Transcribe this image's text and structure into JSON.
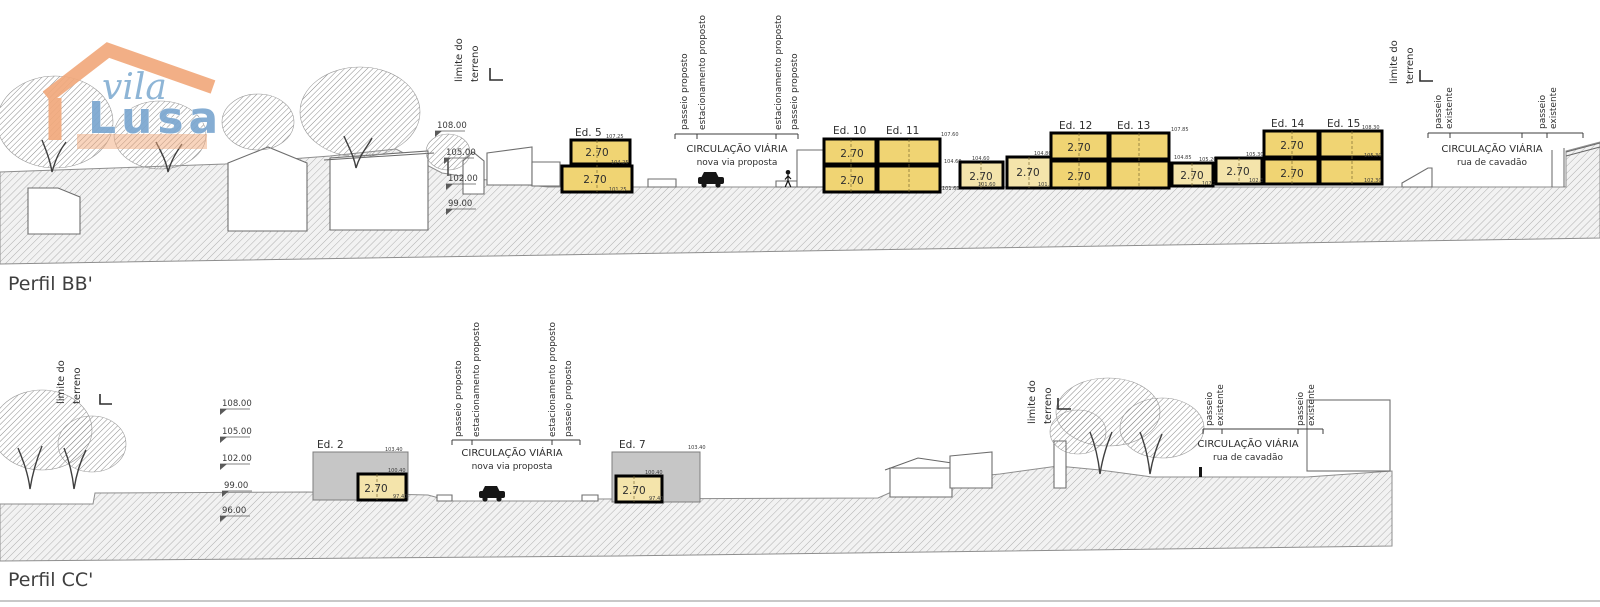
{
  "colors": {
    "proposed_building_fill": "#f0d473",
    "infill_building_fill": "#f4e4ab",
    "existing_building_fill": "#c6c6c6",
    "ground_hatch_line": "#a8a8a8",
    "logo_orange": "#f1a97c",
    "logo_blue": "#7ba7d0"
  },
  "logo": {
    "word1": "vila",
    "word2": "Lusa"
  },
  "labels": {
    "limite_line1": "limite do",
    "limite_line2": "terreno",
    "passeio_proposto": "passeio proposto",
    "estacionamento_proposto": "estacionamento proposto",
    "passeio_line1": "passeio",
    "existente_line2": "existente",
    "circulacao_viaria": "CIRCULAÇÃO VIÁRIA",
    "nova_via_proposta": "nova via proposta",
    "rua_de_cavadao": "rua de cavadão"
  },
  "profile_bb": {
    "title": "Perfil BB'",
    "elevations": [
      "108.00",
      "105.00",
      "102.00",
      "99.00"
    ],
    "buildings": [
      {
        "label": "Ed. 5",
        "floor_height": "2.70",
        "marks": [
          "107.25",
          "104.25",
          "101.25"
        ]
      },
      {
        "label": "Ed. 10",
        "floor_height": "2.70",
        "marks": [
          "107.60",
          "104.60",
          "101.60"
        ]
      },
      {
        "label": "Ed. 11"
      },
      {
        "label": "Ed. 12",
        "floor_height": "2.70",
        "marks": [
          "107.85",
          "104.85",
          "101.85"
        ]
      },
      {
        "label": "Ed. 13"
      },
      {
        "label": "Ed. 14",
        "floor_height": "2.70",
        "marks": [
          "108.30",
          "105.30",
          "102.30"
        ]
      },
      {
        "label": "Ed. 15"
      }
    ],
    "infill_units": [
      {
        "floor_height": "2.70",
        "marks": [
          "104.60",
          "101.60"
        ]
      },
      {
        "floor_height": "2.70",
        "marks": [
          "104.80",
          "101.80"
        ]
      },
      {
        "floor_height": "2.70",
        "marks": [
          "105.20",
          "102.20"
        ]
      },
      {
        "floor_height": "2.70",
        "marks": [
          "105.30",
          "102.30"
        ]
      }
    ]
  },
  "profile_cc": {
    "title": "Perfil CC'",
    "elevations": [
      "108.00",
      "105.00",
      "102.00",
      "99.00",
      "96.00"
    ],
    "buildings": [
      {
        "label": "Ed. 2",
        "floor_height": "2.70",
        "marks": [
          "103.40",
          "100.40",
          "97.40"
        ]
      },
      {
        "label": "Ed. 7",
        "floor_height": "2.70",
        "marks": [
          "103.40",
          "100.40",
          "97.40"
        ]
      }
    ]
  }
}
